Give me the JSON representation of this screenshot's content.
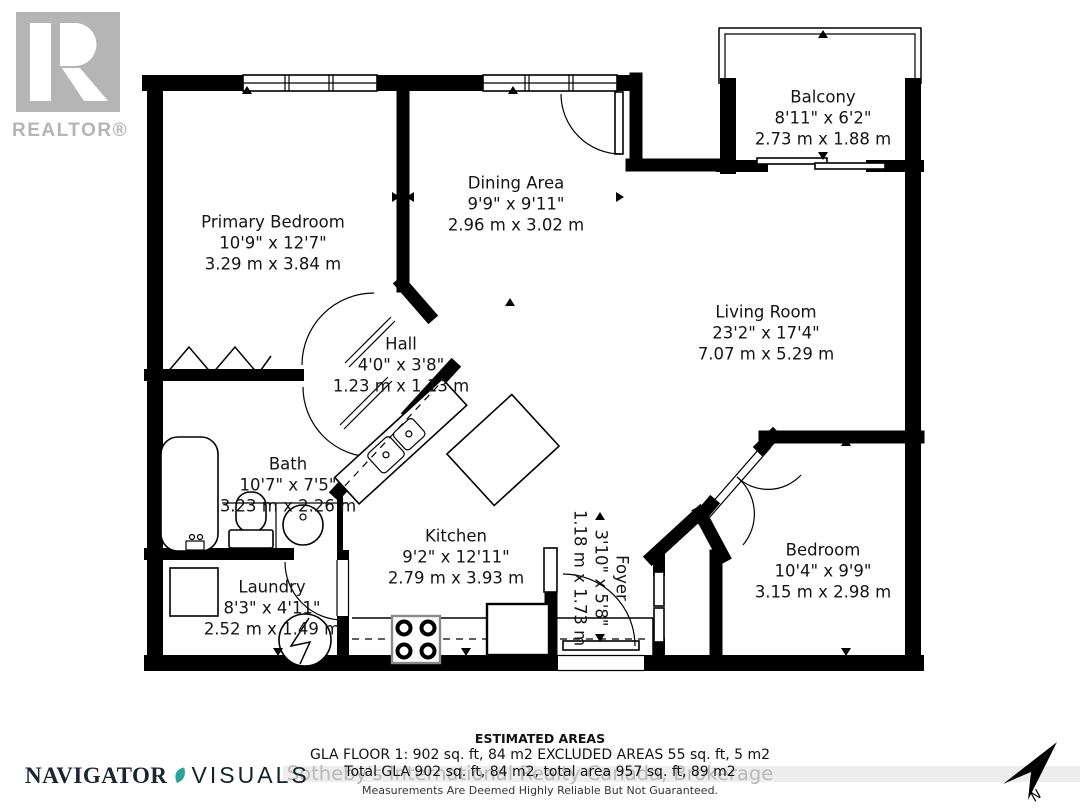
{
  "branding": {
    "realtor_logo_text": "REALTOR®",
    "navigator_word1": "NAVIGATOR",
    "navigator_word2": "VISUALS",
    "watermark": "Sotheby's International Realty Canada, Brokerage",
    "compass_label": "N"
  },
  "rooms": [
    {
      "name": "Primary Bedroom",
      "imperial": "10'9\" x 12'7\"",
      "metric": "3.29 m x 3.84 m"
    },
    {
      "name": "Dining Area",
      "imperial": "9'9\" x 9'11\"",
      "metric": "2.96 m x 3.02 m"
    },
    {
      "name": "Balcony",
      "imperial": "8'11\" x 6'2\"",
      "metric": "2.73 m x 1.88 m"
    },
    {
      "name": "Living Room",
      "imperial": "23'2\" x 17'4\"",
      "metric": "7.07 m x 5.29 m"
    },
    {
      "name": "Hall",
      "imperial": "4'0\" x 3'8\"",
      "metric": "1.23 m x 1.13 m"
    },
    {
      "name": "Bath",
      "imperial": "10'7\" x 7'5\"",
      "metric": "3.23 m x 2.26 m"
    },
    {
      "name": "Kitchen",
      "imperial": "9'2\" x 12'11\"",
      "metric": "2.79 m x 3.93 m"
    },
    {
      "name": "Laundry",
      "imperial": "8'3\" x 4'11\"",
      "metric": "2.52 m x 1.49 m"
    },
    {
      "name": "Foyer",
      "imperial": "3'10\" x 5'8\"",
      "metric": "1.18 m x 1.73 m"
    },
    {
      "name": "Bedroom",
      "imperial": "10'4\" x 9'9\"",
      "metric": "3.15 m x 2.98 m"
    }
  ],
  "areas": {
    "title": "ESTIMATED AREAS",
    "line1": "GLA FLOOR 1: 902 sq. ft, 84 m2 EXCLUDED AREAS 55 sq. ft, 5 m2",
    "line2": "Total GLA 902 sq. ft, 84 m2, total area 957 sq. ft, 89 m2",
    "disclaimer": "Measurements Are Deemed Highly Reliable But Not Guaranteed."
  },
  "colors": {
    "wall": "#000000",
    "label": "#141414",
    "logo_gray": "#b5b5b5",
    "watermark_gray": "#b9b9b9",
    "leaf_teal": "#2ba39b"
  }
}
